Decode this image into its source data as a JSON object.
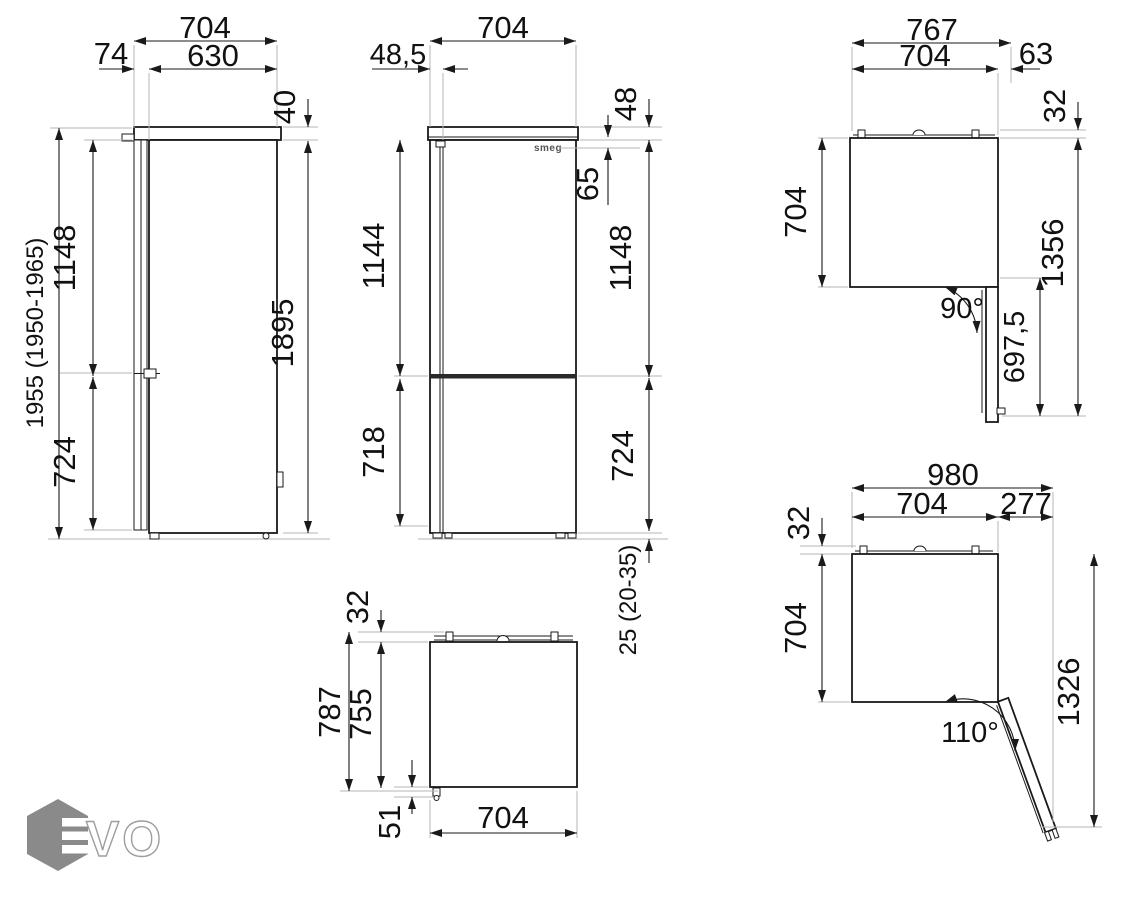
{
  "document": {
    "kind": "appliance-dimension-drawing",
    "background": "#ffffff"
  },
  "brand": {
    "door_logo": "smeg"
  },
  "watermark": {
    "letters": "VO",
    "hex_color": "#8a8a8a",
    "outline_color": "#9e9e9e"
  },
  "colors": {
    "line": "#1a1a1a",
    "extension_line": "#b6b6b6",
    "text": "#111111"
  },
  "dims": {
    "side": {
      "depth_total": "704",
      "depth_body": "630",
      "door_thickness": "74",
      "top_panel": "40",
      "height_total": "1955 (1950-1965)",
      "upper_door": "1148",
      "lower_door": "724",
      "body_height": "1895"
    },
    "front": {
      "width": "704",
      "hinge_offset": "48,5",
      "top_panel": "48",
      "logo_offset": "65",
      "upper_left": "1144",
      "upper_right": "1148",
      "lower_left": "718",
      "lower_right": "724",
      "feet": "25 (20-35)"
    },
    "open90": {
      "width_total": "767",
      "width": "704",
      "hinge_side": "63",
      "rear_gap": "32",
      "depth": "704",
      "door_width": "697,5",
      "reach": "1356",
      "angle": "90°"
    },
    "closed": {
      "rear_gap": "32",
      "depth_total": "787",
      "depth": "755",
      "front_gap": "51",
      "width": "704"
    },
    "open110": {
      "width_total": "980",
      "width": "704",
      "door_side": "277",
      "rear_gap": "32",
      "depth": "704",
      "reach": "1326",
      "angle": "110°"
    }
  }
}
